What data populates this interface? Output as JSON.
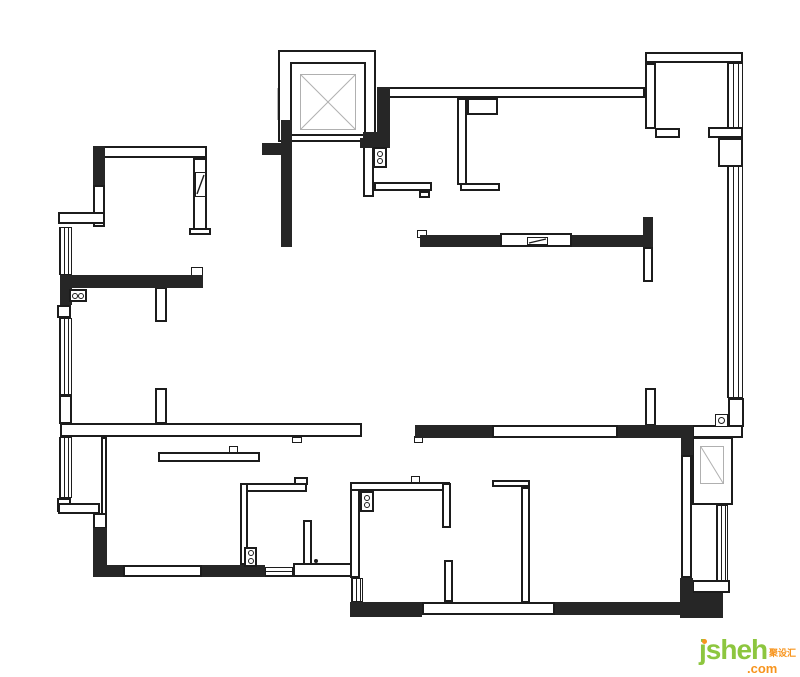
{
  "canvas": {
    "width": 800,
    "height": 677
  },
  "colors": {
    "wall_fill": "#262626",
    "line": "#1c1c1c",
    "faint_line": "#b8b8b8",
    "shaft_line": "#b0b0b0",
    "watermark_green": "#8dc63f",
    "watermark_orange": "#f7941d"
  },
  "watermark": {
    "brand": "jsheh",
    "suffix": ".com",
    "chinese": "聚设汇"
  },
  "floorplan": {
    "windows": [
      {
        "x": 59,
        "y": 227,
        "w": 13,
        "h": 48,
        "dir": "v",
        "gap": 4
      },
      {
        "x": 59,
        "y": 318,
        "w": 13,
        "h": 77,
        "dir": "v",
        "gap": 4
      },
      {
        "x": 59,
        "y": 437,
        "w": 13,
        "h": 61,
        "dir": "v",
        "gap": 4
      },
      {
        "x": 727,
        "y": 63,
        "w": 16,
        "h": 335,
        "dir": "v",
        "gap": 5
      },
      {
        "x": 716,
        "y": 505,
        "w": 12,
        "h": 77,
        "dir": "v",
        "gap": 4
      },
      {
        "x": 277,
        "y": 88,
        "w": 8,
        "h": 32,
        "dir": "v",
        "gap": 3,
        "faint": true
      },
      {
        "x": 265,
        "y": 567,
        "w": 28,
        "h": 10,
        "dir": "h",
        "gap": 4
      },
      {
        "x": 351,
        "y": 578,
        "w": 12,
        "h": 24,
        "dir": "v",
        "gap": 4
      }
    ],
    "outline_walls": [
      {
        "x": 278,
        "y": 50,
        "w": 98,
        "h": 92
      },
      {
        "x": 290,
        "y": 62,
        "w": 76,
        "h": 74
      },
      {
        "x": 388,
        "y": 87,
        "w": 257,
        "h": 11
      },
      {
        "x": 645,
        "y": 52,
        "w": 98,
        "h": 11
      },
      {
        "x": 645,
        "y": 63,
        "w": 11,
        "h": 66
      },
      {
        "x": 655,
        "y": 128,
        "w": 25,
        "h": 10
      },
      {
        "x": 708,
        "y": 127,
        "w": 35,
        "h": 11
      },
      {
        "x": 718,
        "y": 138,
        "w": 25,
        "h": 29
      },
      {
        "x": 643,
        "y": 247,
        "w": 10,
        "h": 35
      },
      {
        "x": 645,
        "y": 388,
        "w": 11,
        "h": 38
      },
      {
        "x": 93,
        "y": 146,
        "w": 114,
        "h": 12
      },
      {
        "x": 193,
        "y": 158,
        "w": 14,
        "h": 77
      },
      {
        "x": 189,
        "y": 228,
        "w": 22,
        "h": 7
      },
      {
        "x": 93,
        "y": 185,
        "w": 12,
        "h": 42
      },
      {
        "x": 58,
        "y": 212,
        "w": 47,
        "h": 12
      },
      {
        "x": 57,
        "y": 305,
        "w": 14,
        "h": 13
      },
      {
        "x": 59,
        "y": 395,
        "w": 13,
        "h": 29
      },
      {
        "x": 57,
        "y": 498,
        "w": 14,
        "h": 14
      },
      {
        "x": 60,
        "y": 423,
        "w": 302,
        "h": 14
      },
      {
        "x": 58,
        "y": 503,
        "w": 42,
        "h": 11
      },
      {
        "x": 101,
        "y": 437,
        "w": 6,
        "h": 78
      },
      {
        "x": 93,
        "y": 513,
        "w": 14,
        "h": 16
      },
      {
        "x": 155,
        "y": 287,
        "w": 12,
        "h": 35
      },
      {
        "x": 155,
        "y": 388,
        "w": 12,
        "h": 36
      },
      {
        "x": 158,
        "y": 452,
        "w": 102,
        "h": 10
      },
      {
        "x": 240,
        "y": 483,
        "w": 67,
        "h": 9
      },
      {
        "x": 294,
        "y": 477,
        "w": 14,
        "h": 8
      },
      {
        "x": 240,
        "y": 483,
        "w": 8,
        "h": 82
      },
      {
        "x": 303,
        "y": 520,
        "w": 9,
        "h": 47
      },
      {
        "x": 293,
        "y": 563,
        "w": 59,
        "h": 14
      },
      {
        "x": 350,
        "y": 482,
        "w": 10,
        "h": 96
      },
      {
        "x": 350,
        "y": 482,
        "w": 100,
        "h": 9
      },
      {
        "x": 442,
        "y": 483,
        "w": 9,
        "h": 45
      },
      {
        "x": 444,
        "y": 560,
        "w": 9,
        "h": 42
      },
      {
        "x": 492,
        "y": 480,
        "w": 38,
        "h": 7
      },
      {
        "x": 521,
        "y": 487,
        "w": 9,
        "h": 116
      },
      {
        "x": 681,
        "y": 455,
        "w": 11,
        "h": 123
      },
      {
        "x": 692,
        "y": 437,
        "w": 41,
        "h": 68
      },
      {
        "x": 692,
        "y": 580,
        "w": 38,
        "h": 13
      },
      {
        "x": 728,
        "y": 398,
        "w": 16,
        "h": 29
      },
      {
        "x": 692,
        "y": 425,
        "w": 51,
        "h": 13
      },
      {
        "x": 363,
        "y": 145,
        "w": 11,
        "h": 52
      },
      {
        "x": 374,
        "y": 182,
        "w": 58,
        "h": 9
      },
      {
        "x": 419,
        "y": 191,
        "w": 11,
        "h": 7
      },
      {
        "x": 457,
        "y": 98,
        "w": 10,
        "h": 87
      },
      {
        "x": 460,
        "y": 183,
        "w": 40,
        "h": 8
      },
      {
        "x": 467,
        "y": 98,
        "w": 31,
        "h": 17
      },
      {
        "x": 500,
        "y": 233,
        "w": 72,
        "h": 14
      },
      {
        "x": 492,
        "y": 425,
        "w": 126,
        "h": 13
      },
      {
        "x": 422,
        "y": 602,
        "w": 133,
        "h": 13
      },
      {
        "x": 123,
        "y": 565,
        "w": 79,
        "h": 12
      }
    ],
    "thin_boxes": [
      {
        "x": 191,
        "y": 267,
        "w": 12,
        "h": 9
      },
      {
        "x": 417,
        "y": 230,
        "w": 10,
        "h": 8
      },
      {
        "x": 414,
        "y": 436,
        "w": 9,
        "h": 7
      },
      {
        "x": 229,
        "y": 446,
        "w": 9,
        "h": 7
      },
      {
        "x": 411,
        "y": 476,
        "w": 9,
        "h": 7
      },
      {
        "x": 292,
        "y": 437,
        "w": 10,
        "h": 6
      },
      {
        "x": 527,
        "y": 237,
        "w": 21,
        "h": 8
      },
      {
        "x": 195,
        "y": 172,
        "w": 11,
        "h": 25
      }
    ],
    "solid_walls": [
      {
        "x": 377,
        "y": 87,
        "w": 13,
        "h": 61
      },
      {
        "x": 360,
        "y": 138,
        "w": 17,
        "h": 10
      },
      {
        "x": 363,
        "y": 132,
        "w": 14,
        "h": 16
      },
      {
        "x": 281,
        "y": 120,
        "w": 11,
        "h": 127
      },
      {
        "x": 262,
        "y": 143,
        "w": 19,
        "h": 12
      },
      {
        "x": 93,
        "y": 146,
        "w": 12,
        "h": 39
      },
      {
        "x": 60,
        "y": 275,
        "w": 143,
        "h": 13
      },
      {
        "x": 60,
        "y": 288,
        "w": 12,
        "h": 17
      },
      {
        "x": 420,
        "y": 235,
        "w": 80,
        "h": 12
      },
      {
        "x": 572,
        "y": 235,
        "w": 81,
        "h": 12
      },
      {
        "x": 643,
        "y": 217,
        "w": 10,
        "h": 18
      },
      {
        "x": 93,
        "y": 528,
        "w": 14,
        "h": 49
      },
      {
        "x": 93,
        "y": 565,
        "w": 30,
        "h": 12
      },
      {
        "x": 202,
        "y": 565,
        "w": 63,
        "h": 12
      },
      {
        "x": 350,
        "y": 602,
        "w": 72,
        "h": 15
      },
      {
        "x": 555,
        "y": 602,
        "w": 142,
        "h": 13
      },
      {
        "x": 680,
        "y": 578,
        "w": 13,
        "h": 40
      },
      {
        "x": 693,
        "y": 593,
        "w": 30,
        "h": 25
      },
      {
        "x": 415,
        "y": 425,
        "w": 77,
        "h": 13
      },
      {
        "x": 618,
        "y": 425,
        "w": 75,
        "h": 13
      },
      {
        "x": 681,
        "y": 425,
        "w": 12,
        "h": 30
      }
    ],
    "light_boxes": [
      {
        "x": 300,
        "y": 74,
        "w": 56,
        "h": 56,
        "name": "elevator-shaft-box"
      },
      {
        "x": 700,
        "y": 446,
        "w": 24,
        "h": 38,
        "name": "ac-unit-box"
      }
    ],
    "sockets": [
      {
        "x": 373,
        "y": 147,
        "w": 14,
        "h": 21
      },
      {
        "x": 244,
        "y": 547,
        "w": 13,
        "h": 20
      },
      {
        "x": 360,
        "y": 491,
        "w": 14,
        "h": 21
      },
      {
        "x": 69,
        "y": 289,
        "w": 18,
        "h": 13,
        "horiz": true
      }
    ],
    "circle_boxes": [
      {
        "x": 715,
        "y": 414,
        "w": 13,
        "h": 13
      }
    ],
    "dots": [
      {
        "x": 314,
        "y": 559,
        "w": 4,
        "h": 4
      }
    ],
    "diagonals": [
      {
        "x1": 301,
        "y1": 75,
        "x2": 355,
        "y2": 129,
        "c": "#b0b0b0",
        "w": 1
      },
      {
        "x1": 355,
        "y1": 75,
        "x2": 301,
        "y2": 129,
        "c": "#b0b0b0",
        "w": 1
      },
      {
        "x1": 701,
        "y1": 447,
        "x2": 723,
        "y2": 483,
        "c": "#b0b0b0",
        "w": 1
      },
      {
        "x1": 529,
        "y1": 243,
        "x2": 546,
        "y2": 239,
        "c": "#1c1c1c",
        "w": 1.4
      },
      {
        "x1": 197,
        "y1": 194,
        "x2": 204,
        "y2": 175,
        "c": "#1c1c1c",
        "w": 1.4
      }
    ]
  }
}
